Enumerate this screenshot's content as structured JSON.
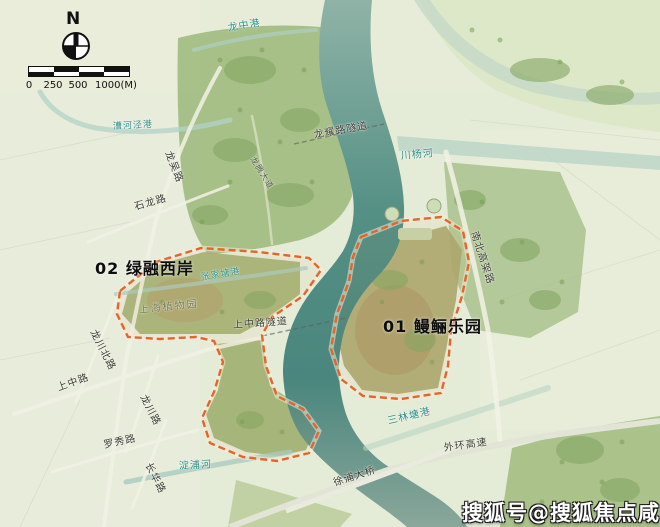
{
  "compass": {
    "north_label": "N"
  },
  "scale_bar": {
    "tick_labels": [
      "0",
      "250",
      "500",
      "1000(M)"
    ]
  },
  "areas": [
    {
      "code": "01",
      "name": "鳗鲡乐园",
      "label": "01 鳗鲡乐园"
    },
    {
      "code": "02",
      "name": "绿融西岸",
      "label": "02 绿融西岸"
    }
  ],
  "labels": [
    {
      "id": "longzhong-gang",
      "text": "龙中港",
      "kind": "water"
    },
    {
      "id": "caohejing-gang",
      "text": "漕河泾港",
      "kind": "water"
    },
    {
      "id": "longwu-road",
      "text": "龙吴路",
      "kind": "road"
    },
    {
      "id": "shilong-road",
      "text": "石龙路",
      "kind": "road"
    },
    {
      "id": "longyao-road-tunnel",
      "text": "龙耀路隧道",
      "kind": "road"
    },
    {
      "id": "longteng-avenue",
      "text": "龙腾大道",
      "kind": "road"
    },
    {
      "id": "chuanyang-river",
      "text": "川杨河",
      "kind": "water"
    },
    {
      "id": "nanbei-elevated-road",
      "text": "南北高架路",
      "kind": "road"
    },
    {
      "id": "shanghai-botanical-garden",
      "text": "上海植物园",
      "kind": "place"
    },
    {
      "id": "zhangjiatang-gang",
      "text": "张家塘港",
      "kind": "water"
    },
    {
      "id": "shangzhong-road-tunnel",
      "text": "上中路隧道",
      "kind": "road"
    },
    {
      "id": "longchuan-north-road",
      "text": "龙川北路",
      "kind": "road"
    },
    {
      "id": "shangzhong-road",
      "text": "上中路",
      "kind": "road"
    },
    {
      "id": "longchuan-road",
      "text": "龙川路",
      "kind": "road"
    },
    {
      "id": "luoxiu-road",
      "text": "罗秀路",
      "kind": "road"
    },
    {
      "id": "changhua-road",
      "text": "长华路",
      "kind": "road"
    },
    {
      "id": "dianpu-river",
      "text": "淀浦河",
      "kind": "water"
    },
    {
      "id": "sanlintang-gang",
      "text": "三林塘港",
      "kind": "water"
    },
    {
      "id": "waihuan-expressway",
      "text": "外环高速",
      "kind": "road"
    },
    {
      "id": "xupu-bridge",
      "text": "徐浦大桥",
      "kind": "road"
    }
  ],
  "watermark": {
    "text": "搜狐号@搜狐焦点咸宁站"
  },
  "colors": {
    "land": "#e4ebd6",
    "river": "#4f8a80",
    "boundary": "#e0662f",
    "water_label": "#2f8e88",
    "road_label": "#3a3c30"
  }
}
